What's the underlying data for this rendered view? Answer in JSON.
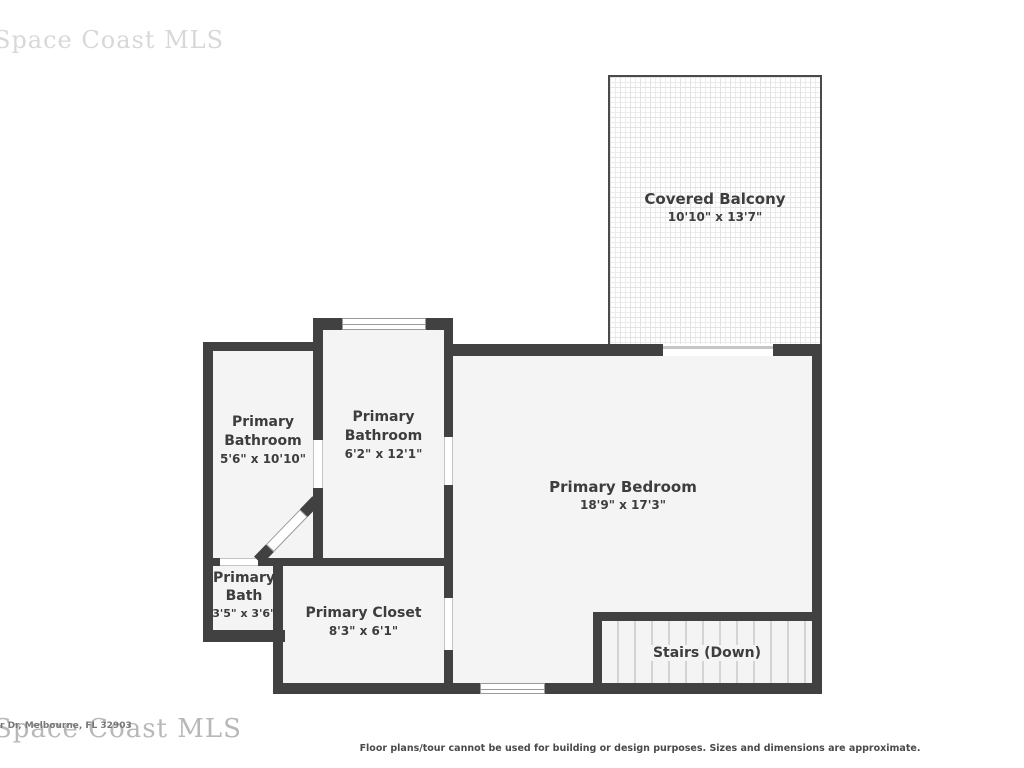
{
  "watermark": {
    "top_text": "Space Coast MLS",
    "bottom_text": "Space Coast MLS",
    "overlay_address": "r Dr, Melbourne, FL 32903"
  },
  "disclaimer": "Floor plans/tour cannot be used for building or design purposes. Sizes and dimensions are approximate.",
  "colors": {
    "wall": "#414141",
    "room_fill": "#f4f4f4",
    "label_text": "#3d3d3d",
    "balcony_pattern": "#e3e3e3",
    "stair_tread": "#d4d4d4",
    "watermark_gray": "#b8b8b8"
  },
  "rooms": [
    {
      "id": "covered-balcony",
      "name": "Covered Balcony",
      "name_line1": "Covered Balcony",
      "name_line2": "",
      "dimensions": "10'10\" x 13'7\""
    },
    {
      "id": "primary-bathroom-left",
      "name": "Primary Bathroom",
      "name_line1": "Primary",
      "name_line2": "Bathroom",
      "dimensions": "5'6\" x 10'10\""
    },
    {
      "id": "primary-bathroom-mid",
      "name": "Primary Bathroom",
      "name_line1": "Primary",
      "name_line2": "Bathroom",
      "dimensions": "6'2\" x 12'1\""
    },
    {
      "id": "primary-bedroom",
      "name": "Primary Bedroom",
      "name_line1": "Primary Bedroom",
      "name_line2": "",
      "dimensions": "18'9\" x 17'3\""
    },
    {
      "id": "primary-bath",
      "name": "Primary Bath",
      "name_line1": "Primary",
      "name_line2": "Bath",
      "dimensions": "3'5\" x 3'6\""
    },
    {
      "id": "primary-closet",
      "name": "Primary Closet",
      "name_line1": "Primary Closet",
      "name_line2": "",
      "dimensions": "8'3\" x 6'1\""
    },
    {
      "id": "stairs",
      "name": "Stairs (Down)",
      "name_line1": "Stairs (Down)",
      "name_line2": "",
      "dimensions": ""
    }
  ]
}
